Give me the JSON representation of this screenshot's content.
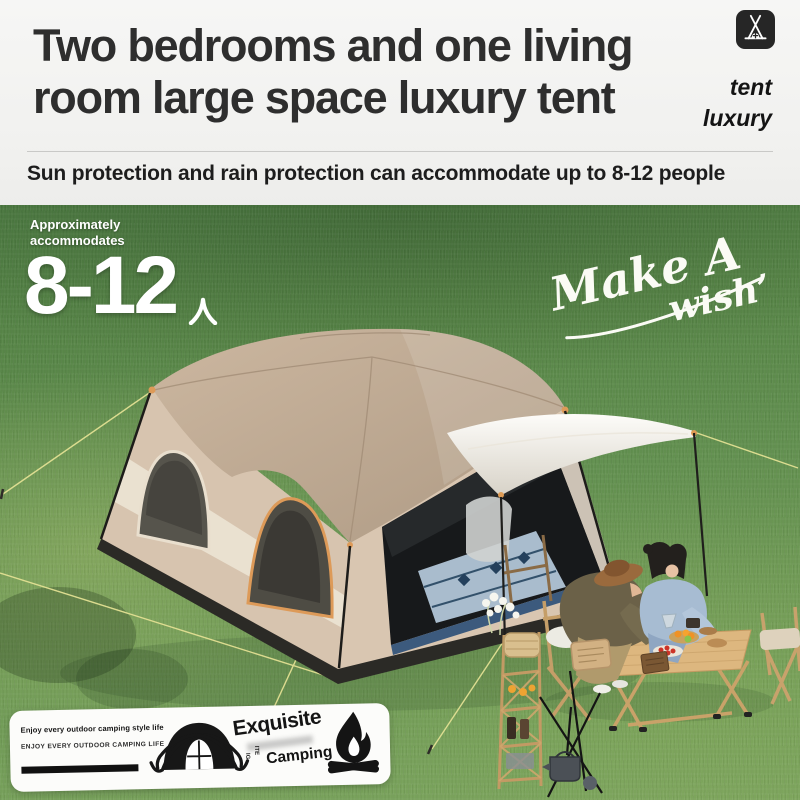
{
  "header": {
    "title_line1": "Two bedrooms and one living",
    "title_line2": "room large space luxury tent",
    "subtitle": "Sun protection and rain protection can accommodate up to 8-12 people",
    "brand_word1": "tent",
    "brand_word2": "luxury"
  },
  "hero": {
    "capacity_label_line1": "Approximately",
    "capacity_label_line2": "accommodates",
    "capacity_value": "8-12",
    "capacity_unit": "人",
    "script_line1": "Make A",
    "script_line2": "wish’"
  },
  "badge": {
    "tagline": "Enjoy every outdoor camping style life",
    "tagline_caps": "ENJOY EVERY OUTDOOR CAMPING LIFE",
    "word_top": "Exquisite",
    "word_bottom": "Camping",
    "vertical_text_1": "ITE",
    "vertical_text_2": "IG"
  },
  "icons": {
    "brand": "tent-icon",
    "badge_left": "dome-tent-icon",
    "badge_right": "campfire-icon",
    "capacity_unit_icon": "person-kanji-icon"
  },
  "colors": {
    "headline": "#2e2e2e",
    "grass_green": "#5d8a4c",
    "tent_roof_tan": "#c0ab94",
    "tent_wall_beige": "#d8c5b0",
    "trim_orange": "#dd9a58",
    "canopy_white": "#f6f4ee",
    "table_wood": "#ddb77f"
  }
}
